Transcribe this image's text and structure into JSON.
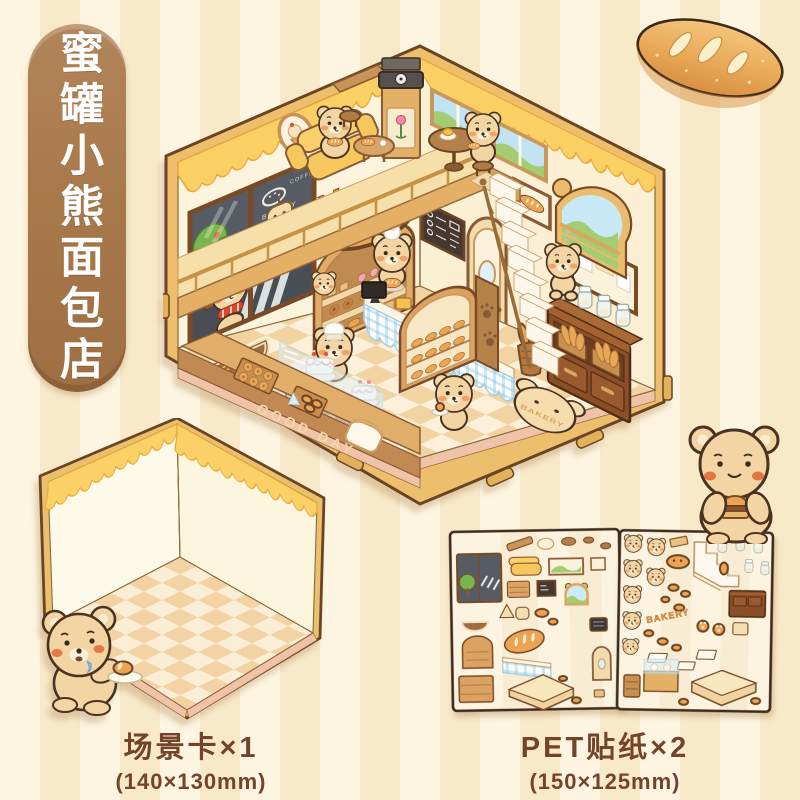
{
  "badge": {
    "text": "蜜罐小熊面包店",
    "bg_color": "#A8794B",
    "text_color": "#FFFFFF"
  },
  "scene": {
    "wall_sign": "BAKERY",
    "window_logo": "BAKERY",
    "window_coffee": "COFFEE",
    "door_mat": "HELLO",
    "counter_front": "GOOD DAY",
    "floor_rug": "BAKERY"
  },
  "products": {
    "scene_card": {
      "label": "场景卡×1",
      "dims": "(140×130mm)"
    },
    "pet_stickers": {
      "label": "PET贴纸×2",
      "dims": "(150×125mm)",
      "sheet_text": "BAKERY"
    }
  },
  "icons": {
    "bread_loaf": "bread-loaf-icon",
    "corner_bear": "bear-with-bun-icon",
    "drooling_bear": "drooling-bear-icon"
  },
  "colors": {
    "stripe_light": "#FDF5E1",
    "stripe_dark": "#F8E9C9",
    "badge_brown": "#A8794B",
    "label_text": "#75432A",
    "honey": "#FACF63",
    "frame_gold": "#EDBF6C",
    "outline_brown": "#6B4423",
    "wall_cream": "#FDF4DE",
    "floor_check": "#F2D3A2",
    "counter_wood": "#E0AE68",
    "glass_blue": "#DDF0F8",
    "gingham_blue": "#CBE6F5",
    "cabinet_dark": "#8A4E28"
  }
}
